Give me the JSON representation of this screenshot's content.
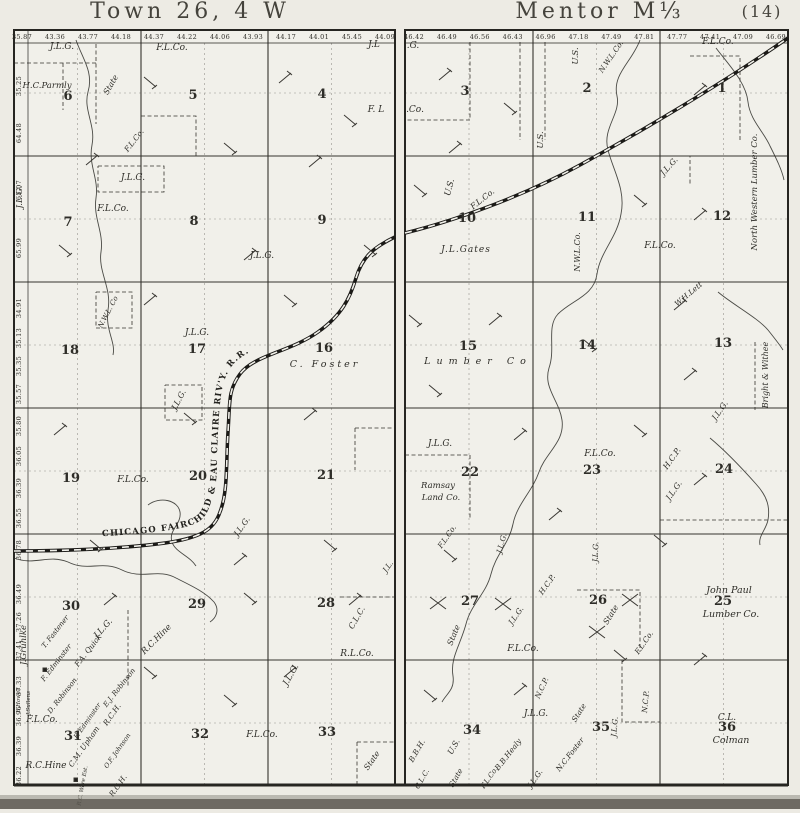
{
  "titles": {
    "left": "Town 26, 4 W",
    "right": "Mentor M⅓",
    "page_num": "(14)"
  },
  "railroad": {
    "name": "CHICAGO FAIRCHILD & EAU CLAIRE RIV'Y. R.R."
  },
  "left_map": {
    "top_acreage": [
      "35.87",
      "43.36",
      "43.77",
      "44.18",
      "44.37",
      "44.22",
      "44.06",
      "43.93",
      "44.17",
      "44.01",
      "45.45",
      "44.09"
    ],
    "edge_acreage": [
      {
        "v": "35.25",
        "y": 86
      },
      {
        "v": "64.48",
        "y": 133
      },
      {
        "v": "65.07",
        "y": 190
      },
      {
        "v": "65.99",
        "y": 248
      },
      {
        "v": "34.91",
        "y": 308
      },
      {
        "v": "35.13",
        "y": 338
      },
      {
        "v": "35.35",
        "y": 366
      },
      {
        "v": "35.57",
        "y": 394
      },
      {
        "v": "35.80",
        "y": 426
      },
      {
        "v": "36.05",
        "y": 456
      },
      {
        "v": "36.39",
        "y": 488
      },
      {
        "v": "36.55",
        "y": 518
      },
      {
        "v": "36.78",
        "y": 550
      },
      {
        "v": "36.49",
        "y": 594
      },
      {
        "v": "37.26",
        "y": 622
      },
      {
        "v": "37.41",
        "y": 650
      },
      {
        "v": "37.33",
        "y": 686
      },
      {
        "v": "36.96",
        "y": 716
      },
      {
        "v": "36.39",
        "y": 746
      },
      {
        "v": "36.22",
        "y": 776
      }
    ],
    "sections": [
      {
        "n": "6",
        "x": 68,
        "y": 100
      },
      {
        "n": "5",
        "x": 193,
        "y": 99
      },
      {
        "n": "4",
        "x": 322,
        "y": 98
      },
      {
        "n": "7",
        "x": 68,
        "y": 226
      },
      {
        "n": "8",
        "x": 194,
        "y": 225
      },
      {
        "n": "9",
        "x": 322,
        "y": 224
      },
      {
        "n": "18",
        "x": 70,
        "y": 354
      },
      {
        "n": "17",
        "x": 197,
        "y": 353
      },
      {
        "n": "16",
        "x": 324,
        "y": 352
      },
      {
        "n": "19",
        "x": 71,
        "y": 482
      },
      {
        "n": "20",
        "x": 198,
        "y": 480
      },
      {
        "n": "21",
        "x": 326,
        "y": 479
      },
      {
        "n": "30",
        "x": 71,
        "y": 610
      },
      {
        "n": "29",
        "x": 197,
        "y": 608
      },
      {
        "n": "28",
        "x": 326,
        "y": 607
      },
      {
        "n": "31",
        "x": 73,
        "y": 740
      },
      {
        "n": "32",
        "x": 200,
        "y": 738
      },
      {
        "n": "33",
        "x": 327,
        "y": 736
      }
    ],
    "owners": [
      {
        "t": "J.L.G.",
        "x": 62,
        "y": 49
      },
      {
        "t": "F.L.Co.",
        "x": 172,
        "y": 50
      },
      {
        "t": "J.L",
        "x": 374,
        "y": 47
      },
      {
        "t": "H.C.Parmly",
        "x": 47,
        "y": 88,
        "s": 8.5
      },
      {
        "t": "State",
        "x": 113,
        "y": 86,
        "r": -60,
        "s": 8
      },
      {
        "t": "F. L",
        "x": 376,
        "y": 112
      },
      {
        "t": "F.L.Co.",
        "x": 136,
        "y": 142,
        "r": -52,
        "s": 7.5
      },
      {
        "t": "J.L.G.",
        "x": 133,
        "y": 180
      },
      {
        "t": "J.L.G.",
        "x": 22,
        "y": 197,
        "r": -90,
        "s": 8.5
      },
      {
        "t": "F.L.Co.",
        "x": 113,
        "y": 211
      },
      {
        "t": "J.L.G.",
        "x": 262,
        "y": 258
      },
      {
        "t": "N.W.L. Co",
        "x": 110,
        "y": 313,
        "r": -62,
        "s": 7
      },
      {
        "t": "J.L.G.",
        "x": 197,
        "y": 335
      },
      {
        "t": "C. Foster",
        "x": 325,
        "y": 367,
        "s": 9.5,
        "sp": 3
      },
      {
        "t": "J.L.G.",
        "x": 181,
        "y": 401,
        "r": -62,
        "s": 8
      },
      {
        "t": "F.L.Co.",
        "x": 133,
        "y": 482
      },
      {
        "t": "J.L.G.",
        "x": 244,
        "y": 528,
        "r": -55,
        "s": 8
      },
      {
        "t": "J.L.",
        "x": 390,
        "y": 568,
        "r": -55,
        "s": 7.5
      },
      {
        "t": "J.Gruhlke",
        "x": 26,
        "y": 645,
        "r": -90,
        "s": 8.5
      },
      {
        "t": "T. Fastener",
        "x": 57,
        "y": 633,
        "r": -52,
        "s": 7
      },
      {
        "t": "F. Edminster",
        "x": 58,
        "y": 664,
        "r": -52,
        "s": 7
      },
      {
        "t": "F.A. Quick",
        "x": 90,
        "y": 652,
        "r": -52,
        "s": 7.5
      },
      {
        "t": "J.L.G.",
        "x": 105,
        "y": 630,
        "r": -48,
        "s": 8.5
      },
      {
        "t": "E.J. Robinson",
        "x": 121,
        "y": 689,
        "r": -52,
        "s": 7
      },
      {
        "t": "D. Robinson",
        "x": 64,
        "y": 697,
        "r": -52,
        "s": 7
      },
      {
        "t": "E.Howell",
        "x": 20,
        "y": 700,
        "r": -90,
        "s": 5.5
      },
      {
        "t": "J.Sullens",
        "x": 30,
        "y": 703,
        "r": -90,
        "s": 5.5
      },
      {
        "t": "R.C.Hine",
        "x": 158,
        "y": 641,
        "r": -45,
        "s": 8.5
      },
      {
        "t": "C.L.C.",
        "x": 359,
        "y": 619,
        "r": -60,
        "s": 8
      },
      {
        "t": "R.L.Co.",
        "x": 357,
        "y": 656
      },
      {
        "t": "J.L.G.",
        "x": 293,
        "y": 676,
        "r": -60,
        "s": 8.5
      },
      {
        "t": "F.L.Co.",
        "x": 42,
        "y": 722
      },
      {
        "t": "R.C.Hine",
        "x": 46,
        "y": 768
      },
      {
        "t": "F. Edminster",
        "x": 89,
        "y": 722,
        "r": -55,
        "s": 6.5
      },
      {
        "t": "R.C.H.",
        "x": 114,
        "y": 716,
        "r": -55,
        "s": 7.5
      },
      {
        "t": "C.M. Upham",
        "x": 86,
        "y": 748,
        "r": -55,
        "s": 7.5
      },
      {
        "t": "O.F. Johnson",
        "x": 119,
        "y": 752,
        "r": -55,
        "s": 6.5
      },
      {
        "t": "R.C. Ware Est.",
        "x": 84,
        "y": 786,
        "r": -80,
        "s": 5.5
      },
      {
        "t": "R.C.H.",
        "x": 120,
        "y": 787,
        "r": -55,
        "s": 7.5
      },
      {
        "t": "F.L.Co.",
        "x": 262,
        "y": 737
      },
      {
        "t": "State",
        "x": 374,
        "y": 762,
        "r": -55,
        "s": 8
      }
    ]
  },
  "right_map": {
    "top_acreage": [
      "46.42",
      "46.49",
      "46.56",
      "46.43",
      "46.96",
      "47.18",
      "47.49",
      "47.81",
      "47.77",
      "47.41",
      "47.09",
      "46.69"
    ],
    "sections": [
      {
        "n": "3",
        "x": 465,
        "y": 95
      },
      {
        "n": "2",
        "x": 587,
        "y": 92
      },
      {
        "n": "1",
        "x": 722,
        "y": 92
      },
      {
        "n": "10",
        "x": 467,
        "y": 222
      },
      {
        "n": "11",
        "x": 587,
        "y": 221
      },
      {
        "n": "12",
        "x": 722,
        "y": 220
      },
      {
        "n": "15",
        "x": 468,
        "y": 350
      },
      {
        "n": "14",
        "x": 587,
        "y": 349
      },
      {
        "n": "13",
        "x": 723,
        "y": 347
      },
      {
        "n": "22",
        "x": 470,
        "y": 476
      },
      {
        "n": "23",
        "x": 592,
        "y": 474
      },
      {
        "n": "24",
        "x": 724,
        "y": 473
      },
      {
        "n": "27",
        "x": 470,
        "y": 605
      },
      {
        "n": "26",
        "x": 598,
        "y": 604
      },
      {
        "n": "25",
        "x": 723,
        "y": 605
      },
      {
        "n": "34",
        "x": 472,
        "y": 734
      },
      {
        "n": "35",
        "x": 601,
        "y": 731
      },
      {
        "n": "36",
        "x": 727,
        "y": 731
      }
    ],
    "owners": [
      {
        "t": ".G.",
        "x": 413,
        "y": 48
      },
      {
        "t": "U.S.",
        "x": 578,
        "y": 56,
        "r": -90,
        "s": 8.5
      },
      {
        "t": "N.W.L.Co.",
        "x": 613,
        "y": 58,
        "r": -55,
        "s": 7.5
      },
      {
        "t": "F.L.Co.",
        "x": 718,
        "y": 44
      },
      {
        "t": ".Co.",
        "x": 415,
        "y": 112
      },
      {
        "t": "U.S.",
        "x": 543,
        "y": 140,
        "r": -90,
        "s": 8.5
      },
      {
        "t": "U.S.",
        "x": 452,
        "y": 188,
        "r": -75,
        "s": 8.5
      },
      {
        "t": "F.L.Co.",
        "x": 484,
        "y": 201,
        "r": -38,
        "s": 8
      },
      {
        "t": "J.L.G.",
        "x": 671,
        "y": 168,
        "r": -48,
        "s": 8
      },
      {
        "t": "J.L.Gates",
        "x": 466,
        "y": 252,
        "sp": 1
      },
      {
        "t": "N.W.L.Co.",
        "x": 580,
        "y": 252,
        "r": -90,
        "s": 8
      },
      {
        "t": "F.L.Co.",
        "x": 660,
        "y": 248
      },
      {
        "t": "North Western Lumber Co.",
        "x": 757,
        "y": 192,
        "r": -90,
        "s": 8.5
      },
      {
        "t": "W.H.Lett",
        "x": 690,
        "y": 296,
        "r": -40,
        "s": 7.5
      },
      {
        "t": "Lumber Co",
        "x": 478,
        "y": 364,
        "s": 9.5,
        "sp": 6
      },
      {
        "t": "Bright & Withee",
        "x": 768,
        "y": 375,
        "r": -90,
        "s": 8
      },
      {
        "t": "J.L.G.",
        "x": 722,
        "y": 412,
        "r": -55,
        "s": 8
      },
      {
        "t": "J.L.G.",
        "x": 440,
        "y": 446
      },
      {
        "t": "F.L.Co.",
        "x": 600,
        "y": 456
      },
      {
        "t": "Ramsay",
        "x": 438,
        "y": 488,
        "s": 8.5
      },
      {
        "t": "Land Co.",
        "x": 441,
        "y": 500,
        "s": 8.5
      },
      {
        "t": "H.C.P.",
        "x": 674,
        "y": 460,
        "r": -55,
        "s": 8
      },
      {
        "t": "J.L.G.",
        "x": 676,
        "y": 492,
        "r": -55,
        "s": 8
      },
      {
        "t": "F.L.Co.",
        "x": 449,
        "y": 538,
        "r": -55,
        "s": 7.5
      },
      {
        "t": "J.L.G.",
        "x": 504,
        "y": 544,
        "r": -75,
        "s": 7.5
      },
      {
        "t": "J.L.G.",
        "x": 598,
        "y": 552,
        "r": -88,
        "s": 7.5
      },
      {
        "t": "H.C.P.",
        "x": 549,
        "y": 586,
        "r": -55,
        "s": 7.5
      },
      {
        "t": "J.L.G.",
        "x": 518,
        "y": 617,
        "r": -55,
        "s": 7.5
      },
      {
        "t": "State",
        "x": 456,
        "y": 636,
        "r": -68,
        "s": 8
      },
      {
        "t": "F.L.Co.",
        "x": 523,
        "y": 651
      },
      {
        "t": "State",
        "x": 613,
        "y": 616,
        "r": -58,
        "s": 8
      },
      {
        "t": "F.L.Co.",
        "x": 646,
        "y": 644,
        "r": -55,
        "s": 7.5
      },
      {
        "t": "John Paul",
        "x": 729,
        "y": 593,
        "s": 9.5
      },
      {
        "t": "Lumber Co.",
        "x": 731,
        "y": 617,
        "s": 9.5
      },
      {
        "t": "N.C.P.",
        "x": 544,
        "y": 689,
        "r": -65,
        "s": 7.5
      },
      {
        "t": "J.L.G.",
        "x": 536,
        "y": 716
      },
      {
        "t": "State",
        "x": 581,
        "y": 714,
        "r": -58,
        "s": 7.5
      },
      {
        "t": "J.L.G.",
        "x": 617,
        "y": 727,
        "r": -85,
        "s": 7.5
      },
      {
        "t": "N.C.P.",
        "x": 648,
        "y": 702,
        "r": -85,
        "s": 7.5
      },
      {
        "t": "B.B.H.",
        "x": 419,
        "y": 752,
        "r": -60,
        "s": 7.5
      },
      {
        "t": "U.S.",
        "x": 456,
        "y": 748,
        "r": -60,
        "s": 8
      },
      {
        "t": "B.B.Healy",
        "x": 510,
        "y": 756,
        "r": -52,
        "s": 7.5
      },
      {
        "t": "N.C.Foster",
        "x": 572,
        "y": 756,
        "r": -52,
        "s": 7.5
      },
      {
        "t": "C.L.C.",
        "x": 424,
        "y": 780,
        "r": -60,
        "s": 7
      },
      {
        "t": "State",
        "x": 458,
        "y": 779,
        "r": -60,
        "s": 7.5
      },
      {
        "t": "F.L.Co.",
        "x": 491,
        "y": 779,
        "r": -55,
        "s": 7
      },
      {
        "t": "J.L.G.",
        "x": 537,
        "y": 780,
        "r": -55,
        "s": 7.5
      },
      {
        "t": "C.L.",
        "x": 727,
        "y": 720
      },
      {
        "t": "Colman",
        "x": 731,
        "y": 743,
        "s": 9.5
      }
    ],
    "x_marks": [
      [
        438,
        603
      ],
      [
        503,
        604
      ],
      [
        630,
        600
      ],
      [
        597,
        632
      ]
    ]
  }
}
